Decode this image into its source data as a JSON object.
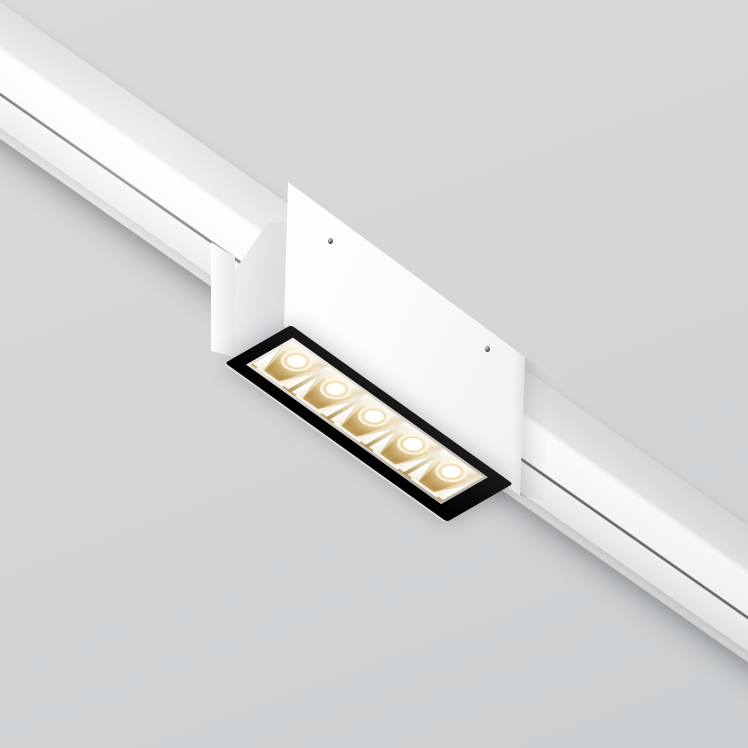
{
  "scene": {
    "description": "Product photo of a white magnetic track rail running diagonally across a light gray background, with a surface-mounted white box fixture carrying a black-framed linear LED spotlight module with five glowing lenses set in gold faceted reflectors",
    "module": {
      "led_count": 5
    }
  },
  "css_vars": {
    "bg-top": "#d7d9da",
    "bg-bottom": "#cccfd1",
    "track-top-a": "#d8dadc",
    "track-top-b": "#e5e7e8",
    "track-face-a": "#ffffff",
    "track-face-b": "#f8fafa",
    "groove": "#54575a",
    "lip-a": "#f4f6f6",
    "lip-b": "#e6e8ea",
    "track-edge": "#c9cccd",
    "box-a": "#ffffff",
    "box-b": "#eef0f2",
    "shade": "#dfe2e4",
    "frame": "#0e0e0f",
    "gold-light": "#ecdcb2",
    "gold-mid": "#d1b275",
    "gold-deep": "#b08c4c",
    "cell-silver": "#fbfaf7",
    "lens-core": "#ffffff",
    "glow": "rgba(255,243,208,0.9)"
  }
}
